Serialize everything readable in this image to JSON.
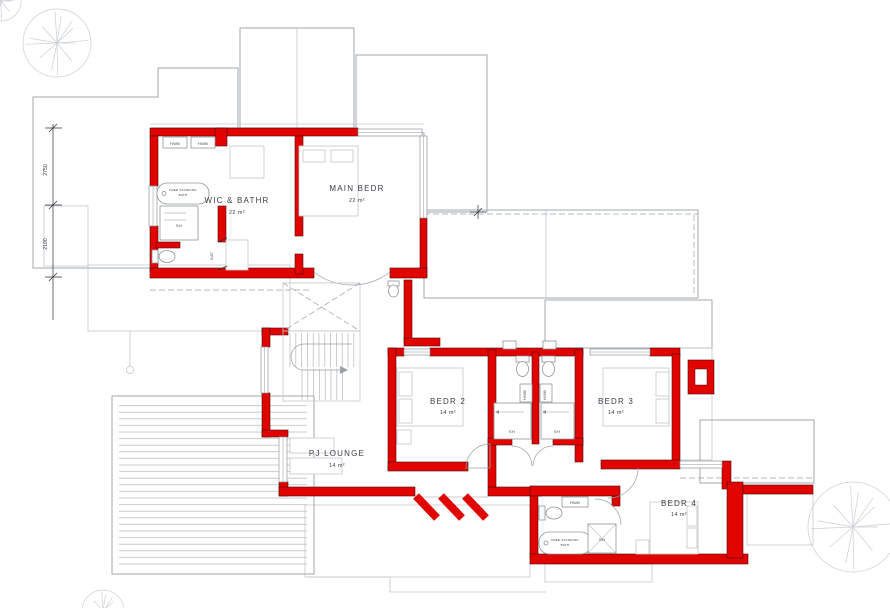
{
  "title": "First floor plan",
  "colors": {
    "wall": "#e10300",
    "outline": "#a3a9ad",
    "text": "#3a3f45"
  },
  "rooms": {
    "wic": {
      "name": "WIC & BATHR",
      "area": "22 m²"
    },
    "main": {
      "name": "MAIN BEDR",
      "area": "22 m²"
    },
    "bedr2": {
      "name": "BEDR 2",
      "area": "14 m²"
    },
    "bedr3": {
      "name": "BEDR 3",
      "area": "14 m²"
    },
    "lounge": {
      "name": "PJ LOUNGE",
      "area": "14 m²"
    },
    "bedr4": {
      "name": "BEDR 4",
      "area": "14 m²"
    }
  },
  "fixtures": {
    "hwb": "HWB",
    "shower": "SH",
    "bath_l1": "FREE STANDING",
    "bath_l2": "BATH"
  },
  "dims": {
    "d1": "2750",
    "d2": "2190",
    "d3": "0,87"
  }
}
